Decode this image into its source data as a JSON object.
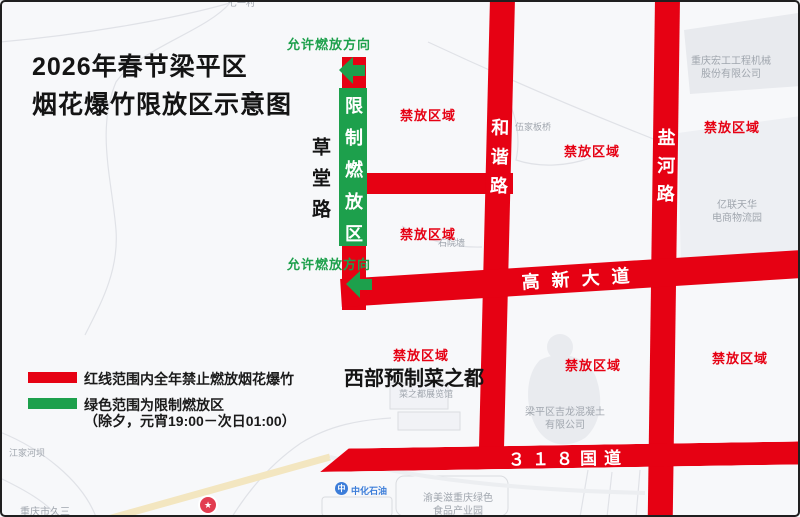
{
  "colors": {
    "road_red": "#e60113",
    "zone_green": "#1da04c",
    "poi_gray": "#a0a6ae",
    "poi_blue": "#3c7dd9",
    "pin_red": "#e23c50"
  },
  "title": {
    "line1": "2026年春节梁平区",
    "line2": "烟花爆竹限放区示意图"
  },
  "legend": {
    "red_text": "红线范围内全年禁止燃放烟花爆竹",
    "green_text": "绿色范围为限制燃放区",
    "green_note": "（除夕，元宵19:00－次日01:00）"
  },
  "roads": {
    "caotang": "草堂路",
    "hexie": "和谐路",
    "yanhe": "盐河路",
    "gaoxin": "高新大道",
    "g318": "３１８国道"
  },
  "zones": {
    "restricted": "限制燃放区",
    "allowed_direction": "允许燃放方向",
    "prohibited": "禁放区域",
    "slogan": "西部预制菜之都"
  },
  "pois": {
    "qiyicun": "七一村",
    "wujiabanqiao": "伍家板桥",
    "shiyuanqiang": "石院墙",
    "honggong_line1": "重庆宏工工程机械",
    "honggong_line2": "股份有限公司",
    "yilian_line1": "亿联天华",
    "yilian_line2": "电商物流园",
    "jiangjiaheba": "江家河坝",
    "jiusan": "重庆市久三",
    "caizhidou_hall": "菜之都展览馆",
    "jilong_line1": "梁平区吉龙混凝土",
    "jilong_line2": "有限公司",
    "yumeizi_line1": "渝美滋重庆绿色",
    "yumeizi_line2": "食品产业园",
    "zhonghua": "中化石油",
    "pin_star": "★"
  }
}
